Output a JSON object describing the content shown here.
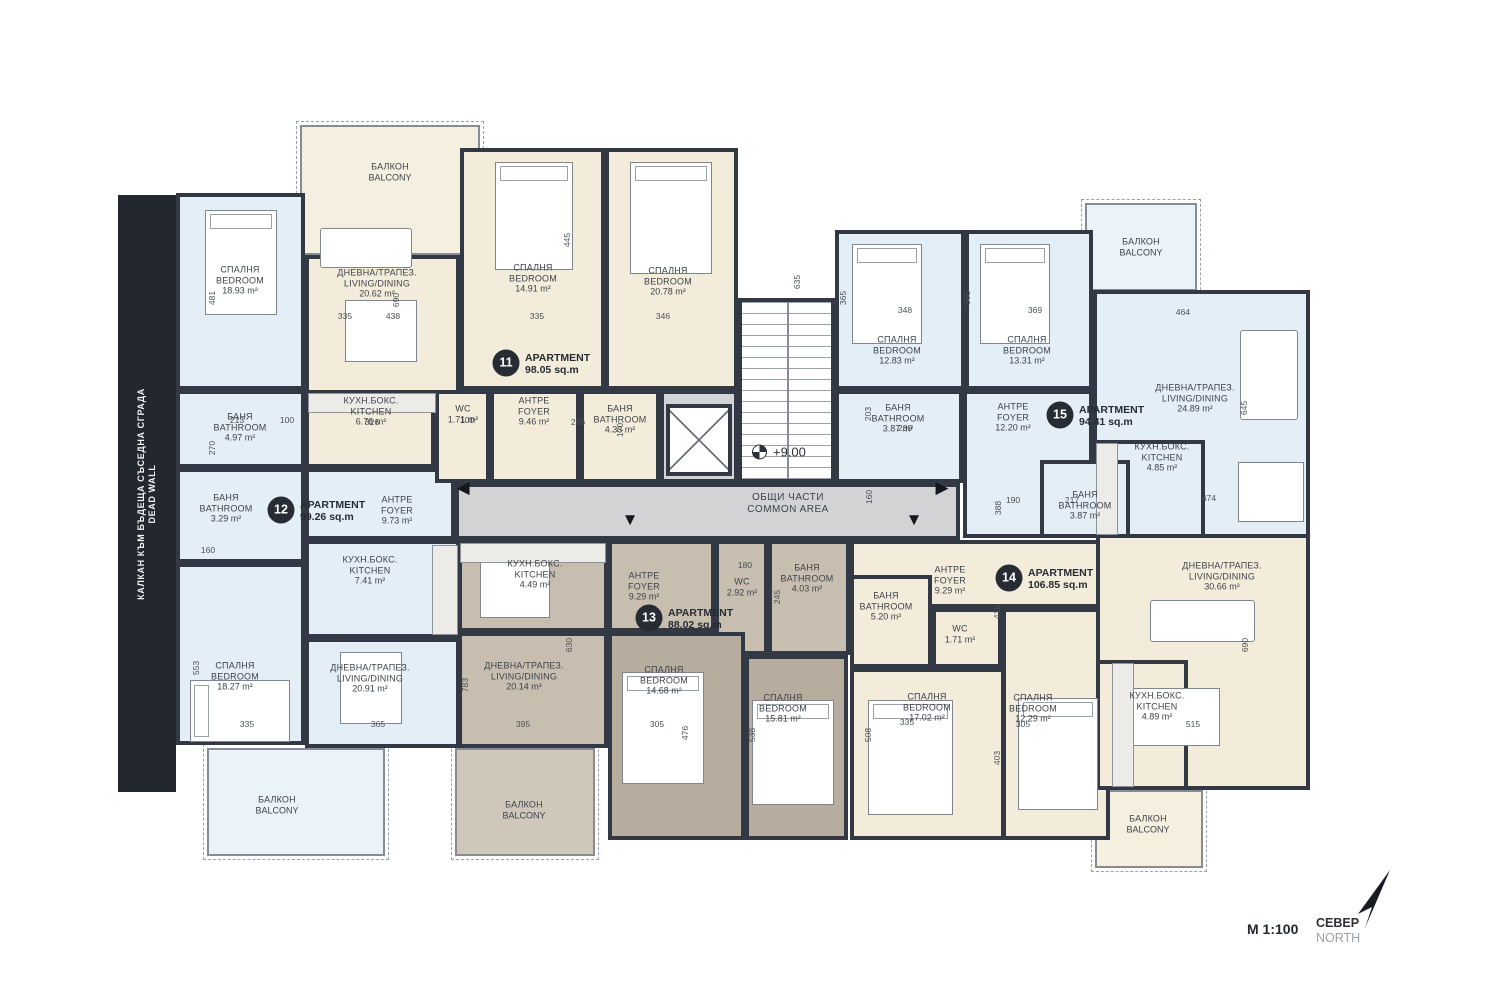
{
  "meta": {
    "scale": "М 1:100",
    "north_bg": "СЕВЕР",
    "north_en": "NORTH"
  },
  "dead_wall": {
    "l1": "КАЛКАН КЪМ БЪДЕЩА СЪСЕДНА СГРАДА",
    "l2": "DEAD WALL"
  },
  "common": {
    "l1": "ОБЩИ ЧАСТИ",
    "l2": "COMMON AREA",
    "elevation": "+9.00"
  },
  "palette": {
    "wall": "#323944",
    "cream": "#f3ecda",
    "blue": "#e4eef7",
    "taupe": "#c7beb0",
    "taupe_dark": "#b7ad9f",
    "gray": "#d2d3d5",
    "balc_cream": "#f5efe0",
    "balc_blue": "#eaf2fa",
    "balc_taupe": "#cfc7ba"
  },
  "apartments": [
    {
      "num": "11",
      "label": "APARTMENT",
      "area": "98.05 sq.m",
      "bx": 506,
      "by": 363,
      "tx": 525,
      "ty": 352
    },
    {
      "num": "12",
      "label": "APARTMENT",
      "area": "99.26 sq.m",
      "bx": 281,
      "by": 510,
      "tx": 300,
      "ty": 499
    },
    {
      "num": "13",
      "label": "APARTMENT",
      "area": "88.02 sq.m",
      "bx": 649,
      "by": 618,
      "tx": 668,
      "ty": 607
    },
    {
      "num": "14",
      "label": "APARTMENT",
      "area": "106.85 sq.m",
      "bx": 1009,
      "by": 578,
      "tx": 1028,
      "ty": 567
    },
    {
      "num": "15",
      "label": "APARTMENT",
      "area": "94.41 sq.m",
      "bx": 1060,
      "by": 415,
      "tx": 1079,
      "ty": 404
    }
  ],
  "rooms": [
    {
      "id": "corridor",
      "c": "gray",
      "x": 455,
      "y": 483,
      "w": 505,
      "h": 57
    },
    {
      "id": "core-block",
      "c": "gray",
      "x": 660,
      "y": 390,
      "w": 78,
      "h": 93
    },
    {
      "id": "apt11-living",
      "c": "cream",
      "x": 305,
      "y": 255,
      "w": 155,
      "h": 228,
      "lx": 377,
      "ly": 283,
      "l1": "ДНЕВНА/ТРАПЕЗ.",
      "l2": "LIVING/DINING",
      "area": "20.62 m²"
    },
    {
      "id": "apt11-bedroom-1",
      "c": "cream",
      "x": 460,
      "y": 148,
      "w": 145,
      "h": 242,
      "lx": 533,
      "ly": 278,
      "l1": "СПАЛНЯ",
      "l2": "BEDROOM",
      "area": "14.91 m²"
    },
    {
      "id": "apt11-bedroom-2",
      "c": "cream",
      "x": 605,
      "y": 148,
      "w": 133,
      "h": 242,
      "lx": 668,
      "ly": 281,
      "l1": "СПАЛНЯ",
      "l2": "BEDROOM",
      "area": "20.78 m²"
    },
    {
      "id": "apt11-kitchen",
      "c": "cream",
      "x": 305,
      "y": 390,
      "w": 130,
      "h": 78,
      "lx": 371,
      "ly": 411,
      "l1": "КУХН.БОКС.",
      "l2": "KITCHEN",
      "area": "6.76 m²"
    },
    {
      "id": "apt12-foyer",
      "c": "blue",
      "x": 305,
      "y": 468,
      "w": 150,
      "h": 72,
      "lx": 397,
      "ly": 510,
      "l1": "АНТРЕ",
      "l2": "FOYER",
      "area": "9.73 m²"
    },
    {
      "id": "apt11-wc",
      "c": "cream",
      "x": 435,
      "y": 390,
      "w": 55,
      "h": 93,
      "lx": 463,
      "ly": 414,
      "l1": "WC",
      "area": "1.71 m²"
    },
    {
      "id": "apt11-foyer",
      "c": "cream",
      "x": 490,
      "y": 390,
      "w": 90,
      "h": 93,
      "lx": 534,
      "ly": 411,
      "l1": "АНТРЕ",
      "l2": "FOYER",
      "area": "9.46 m²"
    },
    {
      "id": "apt11-bathroom",
      "c": "cream",
      "x": 580,
      "y": 390,
      "w": 80,
      "h": 93,
      "lx": 620,
      "ly": 419,
      "l1": "БАНЯ",
      "l2": "BATHROOM",
      "area": "4.33 m²"
    },
    {
      "id": "apt12-bedroom-1",
      "c": "blue",
      "x": 176,
      "y": 193,
      "w": 129,
      "h": 197,
      "lx": 240,
      "ly": 280,
      "l1": "СПАЛНЯ",
      "l2": "BEDROOM",
      "area": "18.93 m²"
    },
    {
      "id": "apt12-bathroom-1",
      "c": "blue",
      "x": 176,
      "y": 390,
      "w": 129,
      "h": 78,
      "lx": 240,
      "ly": 427,
      "l1": "БАНЯ",
      "l2": "BATHROOM",
      "area": "4.97 m²"
    },
    {
      "id": "apt12-bathroom-2",
      "c": "blue",
      "x": 176,
      "y": 468,
      "w": 129,
      "h": 95,
      "lx": 226,
      "ly": 508,
      "l1": "БАНЯ",
      "l2": "BATHROOM",
      "area": "3.29 m²"
    },
    {
      "id": "apt12-kitchen",
      "c": "blue",
      "x": 305,
      "y": 540,
      "w": 155,
      "h": 98,
      "lx": 370,
      "ly": 570,
      "l1": "КУХН.БОКС.",
      "l2": "KITCHEN",
      "area": "7.41 m²"
    },
    {
      "id": "apt12-living",
      "c": "blue",
      "x": 305,
      "y": 638,
      "w": 155,
      "h": 110,
      "lx": 370,
      "ly": 678,
      "l1": "ДНЕВНА/ТРАПЕЗ.",
      "l2": "LIVING/DINING",
      "area": "20.91 m²"
    },
    {
      "id": "apt12-bedroom-2",
      "c": "blue",
      "x": 176,
      "y": 563,
      "w": 129,
      "h": 182,
      "lx": 235,
      "ly": 676,
      "l1": "СПАЛНЯ",
      "l2": "BEDROOM",
      "area": "18.27 m²"
    },
    {
      "id": "apt13-kitchen",
      "c": "taupe",
      "x": 458,
      "y": 540,
      "w": 150,
      "h": 92,
      "lx": 535,
      "ly": 574,
      "l1": "КУХН.БОКС.",
      "l2": "KITCHEN",
      "area": "4.49 m²"
    },
    {
      "id": "apt13-foyer",
      "c": "taupe",
      "x": 608,
      "y": 540,
      "w": 107,
      "h": 92,
      "lx": 644,
      "ly": 586,
      "l1": "АНТРЕ",
      "l2": "FOYER",
      "area": "9.29 m²"
    },
    {
      "id": "apt13-wc",
      "c": "taupe",
      "x": 715,
      "y": 540,
      "w": 53,
      "h": 115,
      "lx": 742,
      "ly": 587,
      "l1": "WC",
      "area": "2.92 m²"
    },
    {
      "id": "apt13-bathroom",
      "c": "taupe",
      "x": 768,
      "y": 540,
      "w": 82,
      "h": 115,
      "lx": 807,
      "ly": 578,
      "l1": "БАНЯ",
      "l2": "BATHROOM",
      "area": "4.03 m²"
    },
    {
      "id": "apt13-living",
      "c": "taupe",
      "x": 458,
      "y": 632,
      "w": 150,
      "h": 116,
      "lx": 524,
      "ly": 676,
      "l1": "ДНЕВНА/ТРАПЕЗ.",
      "l2": "LIVING/DINING",
      "area": "20.14 m²"
    },
    {
      "id": "apt13-bedroom-1",
      "c": "taupe_dark",
      "x": 608,
      "y": 632,
      "w": 137,
      "h": 208,
      "lx": 664,
      "ly": 680,
      "l1": "СПАЛНЯ",
      "l2": "BEDROOM",
      "area": "14.68 m²"
    },
    {
      "id": "apt13-bedroom-2",
      "c": "taupe_dark",
      "x": 745,
      "y": 655,
      "w": 103,
      "h": 185,
      "lx": 783,
      "ly": 708,
      "l1": "СПАЛНЯ",
      "l2": "BEDROOM",
      "area": "15.81 m²"
    },
    {
      "id": "apt14-foyer",
      "c": "cream",
      "x": 850,
      "y": 540,
      "w": 260,
      "h": 68,
      "lx": 950,
      "ly": 580,
      "l1": "АНТРЕ",
      "l2": "FOYER",
      "area": "9.29 m²"
    },
    {
      "id": "apt14-bathroom",
      "c": "cream",
      "x": 850,
      "y": 575,
      "w": 82,
      "h": 93,
      "lx": 886,
      "ly": 606,
      "l1": "БАНЯ",
      "l2": "BATHROOM",
      "area": "5.20 m²"
    },
    {
      "id": "apt14-wc",
      "c": "cream",
      "x": 932,
      "y": 608,
      "w": 70,
      "h": 60,
      "lx": 960,
      "ly": 634,
      "l1": "WC",
      "area": "1.71 m²"
    },
    {
      "id": "apt14-bedroom-1",
      "c": "cream",
      "x": 850,
      "y": 668,
      "w": 155,
      "h": 172,
      "lx": 927,
      "ly": 707,
      "l1": "СПАЛНЯ",
      "l2": "BEDROOM",
      "area": "17.02 m²"
    },
    {
      "id": "apt14-bedroom-2",
      "c": "cream",
      "x": 1002,
      "y": 608,
      "w": 108,
      "h": 232,
      "lx": 1033,
      "ly": 708,
      "l1": "СПАЛНЯ",
      "l2": "BEDROOM",
      "area": "12.29 m²"
    },
    {
      "id": "apt14-living",
      "c": "cream",
      "x": 1096,
      "y": 530,
      "w": 214,
      "h": 260,
      "lx": 1222,
      "ly": 576,
      "l1": "ДНЕВНА/ТРАПЕЗ.",
      "l2": "LIVING/DINING",
      "area": "30.66 m²"
    },
    {
      "id": "apt14-kitchen",
      "c": "cream",
      "x": 1096,
      "y": 660,
      "w": 92,
      "h": 130,
      "lx": 1157,
      "ly": 706,
      "l1": "КУХН.БОКС.",
      "l2": "KITCHEN",
      "area": "4.89 m²"
    },
    {
      "id": "apt15-living",
      "c": "blue",
      "x": 1093,
      "y": 290,
      "w": 217,
      "h": 248,
      "lx": 1195,
      "ly": 398,
      "l1": "ДНЕВНА/ТРАПЕЗ.",
      "l2": "LIVING/DINING",
      "area": "24.89 m²"
    },
    {
      "id": "apt15-kitchen",
      "c": "blue",
      "x": 1093,
      "y": 440,
      "w": 112,
      "h": 98,
      "lx": 1162,
      "ly": 457,
      "l1": "КУХН.БОКС.",
      "l2": "KITCHEN",
      "area": "4.85 m²"
    },
    {
      "id": "apt15-bedroom-1",
      "c": "blue",
      "x": 835,
      "y": 230,
      "w": 130,
      "h": 160,
      "lx": 897,
      "ly": 350,
      "l1": "СПАЛНЯ",
      "l2": "BEDROOM",
      "area": "12.83 m²"
    },
    {
      "id": "apt15-bedroom-2",
      "c": "blue",
      "x": 965,
      "y": 230,
      "w": 128,
      "h": 160,
      "lx": 1027,
      "ly": 350,
      "l1": "СПАЛНЯ",
      "l2": "BEDROOM",
      "area": "13.31 m²"
    },
    {
      "id": "apt15-bathroom-1",
      "c": "blue",
      "x": 835,
      "y": 390,
      "w": 128,
      "h": 93,
      "lx": 898,
      "ly": 418,
      "l1": "БАНЯ",
      "l2": "BATHROOM",
      "area": "3.87 m²"
    },
    {
      "id": "apt15-foyer",
      "c": "blue",
      "x": 963,
      "y": 390,
      "w": 130,
      "h": 148,
      "lx": 1013,
      "ly": 417,
      "l1": "АНТРЕ",
      "l2": "FOYER",
      "area": "12.20 m²"
    },
    {
      "id": "apt15-bathroom-2",
      "c": "blue",
      "x": 1040,
      "y": 460,
      "w": 90,
      "h": 78,
      "lx": 1085,
      "ly": 505,
      "l1": "БАНЯ",
      "l2": "BATHROOM",
      "area": "3.87 m²"
    },
    {
      "id": "stairs",
      "type": "stairs",
      "x": 738,
      "y": 298,
      "w": 97,
      "h": 185
    },
    {
      "id": "elevator",
      "type": "elev",
      "x": 666,
      "y": 404,
      "w": 66,
      "h": 72
    }
  ],
  "balconies": [
    {
      "id": "balcony-apt11",
      "c": "balc_cream",
      "x": 300,
      "y": 125,
      "w": 180,
      "h": 130,
      "lx": 390,
      "ly": 172,
      "l1": "БАЛКОН",
      "l2": "BALCONY"
    },
    {
      "id": "balcony-apt15",
      "c": "balc_blue",
      "x": 1085,
      "y": 203,
      "w": 112,
      "h": 88,
      "lx": 1141,
      "ly": 247,
      "l1": "БАЛКОН",
      "l2": "BALCONY"
    },
    {
      "id": "balcony-apt12",
      "c": "balc_blue",
      "x": 207,
      "y": 748,
      "w": 178,
      "h": 108,
      "lx": 277,
      "ly": 805,
      "l1": "БАЛКОН",
      "l2": "BALCONY"
    },
    {
      "id": "balcony-apt13",
      "c": "balc_taupe",
      "x": 455,
      "y": 748,
      "w": 140,
      "h": 108,
      "lx": 524,
      "ly": 810,
      "l1": "БАЛКОН",
      "l2": "BALCONY"
    },
    {
      "id": "balcony-apt14",
      "c": "balc_cream",
      "x": 1095,
      "y": 790,
      "w": 108,
      "h": 78,
      "lx": 1148,
      "ly": 824,
      "l1": "БАЛКОН",
      "l2": "BALCONY"
    }
  ],
  "dims": [
    {
      "t": "335",
      "x": 345,
      "y": 316
    },
    {
      "t": "438",
      "x": 393,
      "y": 316
    },
    {
      "t": "335",
      "x": 537,
      "y": 316
    },
    {
      "t": "346",
      "x": 663,
      "y": 316
    },
    {
      "t": "348",
      "x": 905,
      "y": 310
    },
    {
      "t": "369",
      "x": 1035,
      "y": 310
    },
    {
      "t": "464",
      "x": 1183,
      "y": 312
    },
    {
      "t": "481",
      "x": 212,
      "y": 298,
      "v": 1
    },
    {
      "t": "690",
      "x": 396,
      "y": 300,
      "v": 1
    },
    {
      "t": "445",
      "x": 567,
      "y": 240,
      "v": 1
    },
    {
      "t": "635",
      "x": 797,
      "y": 282,
      "v": 1
    },
    {
      "t": "365",
      "x": 843,
      "y": 298,
      "v": 1
    },
    {
      "t": "365",
      "x": 967,
      "y": 298,
      "v": 1
    },
    {
      "t": "645",
      "x": 1244,
      "y": 408,
      "v": 1
    },
    {
      "t": "213",
      "x": 237,
      "y": 420
    },
    {
      "t": "100",
      "x": 287,
      "y": 420
    },
    {
      "t": "326",
      "x": 372,
      "y": 422
    },
    {
      "t": "100",
      "x": 467,
      "y": 420
    },
    {
      "t": "296",
      "x": 578,
      "y": 422
    },
    {
      "t": "170",
      "x": 620,
      "y": 430,
      "v": 1
    },
    {
      "t": "270",
      "x": 212,
      "y": 448,
      "v": 1
    },
    {
      "t": "160",
      "x": 208,
      "y": 550
    },
    {
      "t": "203",
      "x": 868,
      "y": 414,
      "v": 1
    },
    {
      "t": "230",
      "x": 905,
      "y": 428
    },
    {
      "t": "388",
      "x": 998,
      "y": 508,
      "v": 1
    },
    {
      "t": "190",
      "x": 1013,
      "y": 500
    },
    {
      "t": "217",
      "x": 1072,
      "y": 500
    },
    {
      "t": "474",
      "x": 1209,
      "y": 498
    },
    {
      "t": "160",
      "x": 869,
      "y": 497,
      "v": 1
    },
    {
      "t": "245",
      "x": 777,
      "y": 597,
      "v": 1
    },
    {
      "t": "180",
      "x": 745,
      "y": 565
    },
    {
      "t": "553",
      "x": 196,
      "y": 668,
      "v": 1
    },
    {
      "t": "630",
      "x": 569,
      "y": 645,
      "v": 1
    },
    {
      "t": "783",
      "x": 465,
      "y": 685,
      "v": 1
    },
    {
      "t": "395",
      "x": 523,
      "y": 724
    },
    {
      "t": "305",
      "x": 657,
      "y": 724
    },
    {
      "t": "476",
      "x": 685,
      "y": 733,
      "v": 1
    },
    {
      "t": "335",
      "x": 247,
      "y": 724
    },
    {
      "t": "365",
      "x": 378,
      "y": 724
    },
    {
      "t": "538",
      "x": 752,
      "y": 735,
      "v": 1
    },
    {
      "t": "508",
      "x": 868,
      "y": 735,
      "v": 1
    },
    {
      "t": "335",
      "x": 907,
      "y": 722
    },
    {
      "t": "305",
      "x": 1023,
      "y": 724
    },
    {
      "t": "415",
      "x": 997,
      "y": 612,
      "v": 1
    },
    {
      "t": "403",
      "x": 997,
      "y": 758,
      "v": 1
    },
    {
      "t": "515",
      "x": 1193,
      "y": 724
    },
    {
      "t": "690",
      "x": 1245,
      "y": 645,
      "v": 1
    }
  ],
  "arrows": [
    {
      "g": "◀",
      "x": 463,
      "y": 488
    },
    {
      "g": "▼",
      "x": 630,
      "y": 520
    },
    {
      "g": "▶",
      "x": 942,
      "y": 488
    },
    {
      "g": "▼",
      "x": 914,
      "y": 520
    }
  ],
  "furniture": [
    {
      "k": "bed",
      "x": 205,
      "y": 210,
      "w": 72,
      "h": 105
    },
    {
      "k": "bed",
      "x": 495,
      "y": 162,
      "w": 78,
      "h": 108
    },
    {
      "k": "bed",
      "x": 630,
      "y": 162,
      "w": 82,
      "h": 112
    },
    {
      "k": "bed",
      "x": 852,
      "y": 244,
      "w": 70,
      "h": 100
    },
    {
      "k": "bed",
      "x": 980,
      "y": 244,
      "w": 70,
      "h": 100
    },
    {
      "k": "bedh",
      "x": 190,
      "y": 680,
      "w": 100,
      "h": 62
    },
    {
      "k": "bed",
      "x": 622,
      "y": 672,
      "w": 82,
      "h": 112
    },
    {
      "k": "bed",
      "x": 752,
      "y": 700,
      "w": 82,
      "h": 105
    },
    {
      "k": "bed",
      "x": 868,
      "y": 700,
      "w": 85,
      "h": 115
    },
    {
      "k": "bed",
      "x": 1018,
      "y": 698,
      "w": 80,
      "h": 112
    },
    {
      "k": "table",
      "x": 345,
      "y": 300,
      "w": 72,
      "h": 62
    },
    {
      "k": "table",
      "x": 340,
      "y": 652,
      "w": 62,
      "h": 72
    },
    {
      "k": "table",
      "x": 480,
      "y": 556,
      "w": 70,
      "h": 62
    },
    {
      "k": "table",
      "x": 1238,
      "y": 462,
      "w": 66,
      "h": 60
    },
    {
      "k": "table",
      "x": 1128,
      "y": 688,
      "w": 92,
      "h": 58
    },
    {
      "k": "sofa",
      "x": 320,
      "y": 228,
      "w": 92,
      "h": 40
    },
    {
      "k": "sofa",
      "x": 1240,
      "y": 330,
      "w": 58,
      "h": 90
    },
    {
      "k": "sofa",
      "x": 1150,
      "y": 600,
      "w": 105,
      "h": 42
    },
    {
      "k": "counter",
      "x": 308,
      "y": 393,
      "w": 128,
      "h": 20
    },
    {
      "k": "counter",
      "x": 432,
      "y": 545,
      "w": 26,
      "h": 90
    },
    {
      "k": "counter",
      "x": 460,
      "y": 543,
      "w": 146,
      "h": 20
    },
    {
      "k": "counter",
      "x": 1096,
      "y": 443,
      "w": 22,
      "h": 92
    },
    {
      "k": "counter",
      "x": 1112,
      "y": 663,
      "w": 22,
      "h": 124
    }
  ]
}
